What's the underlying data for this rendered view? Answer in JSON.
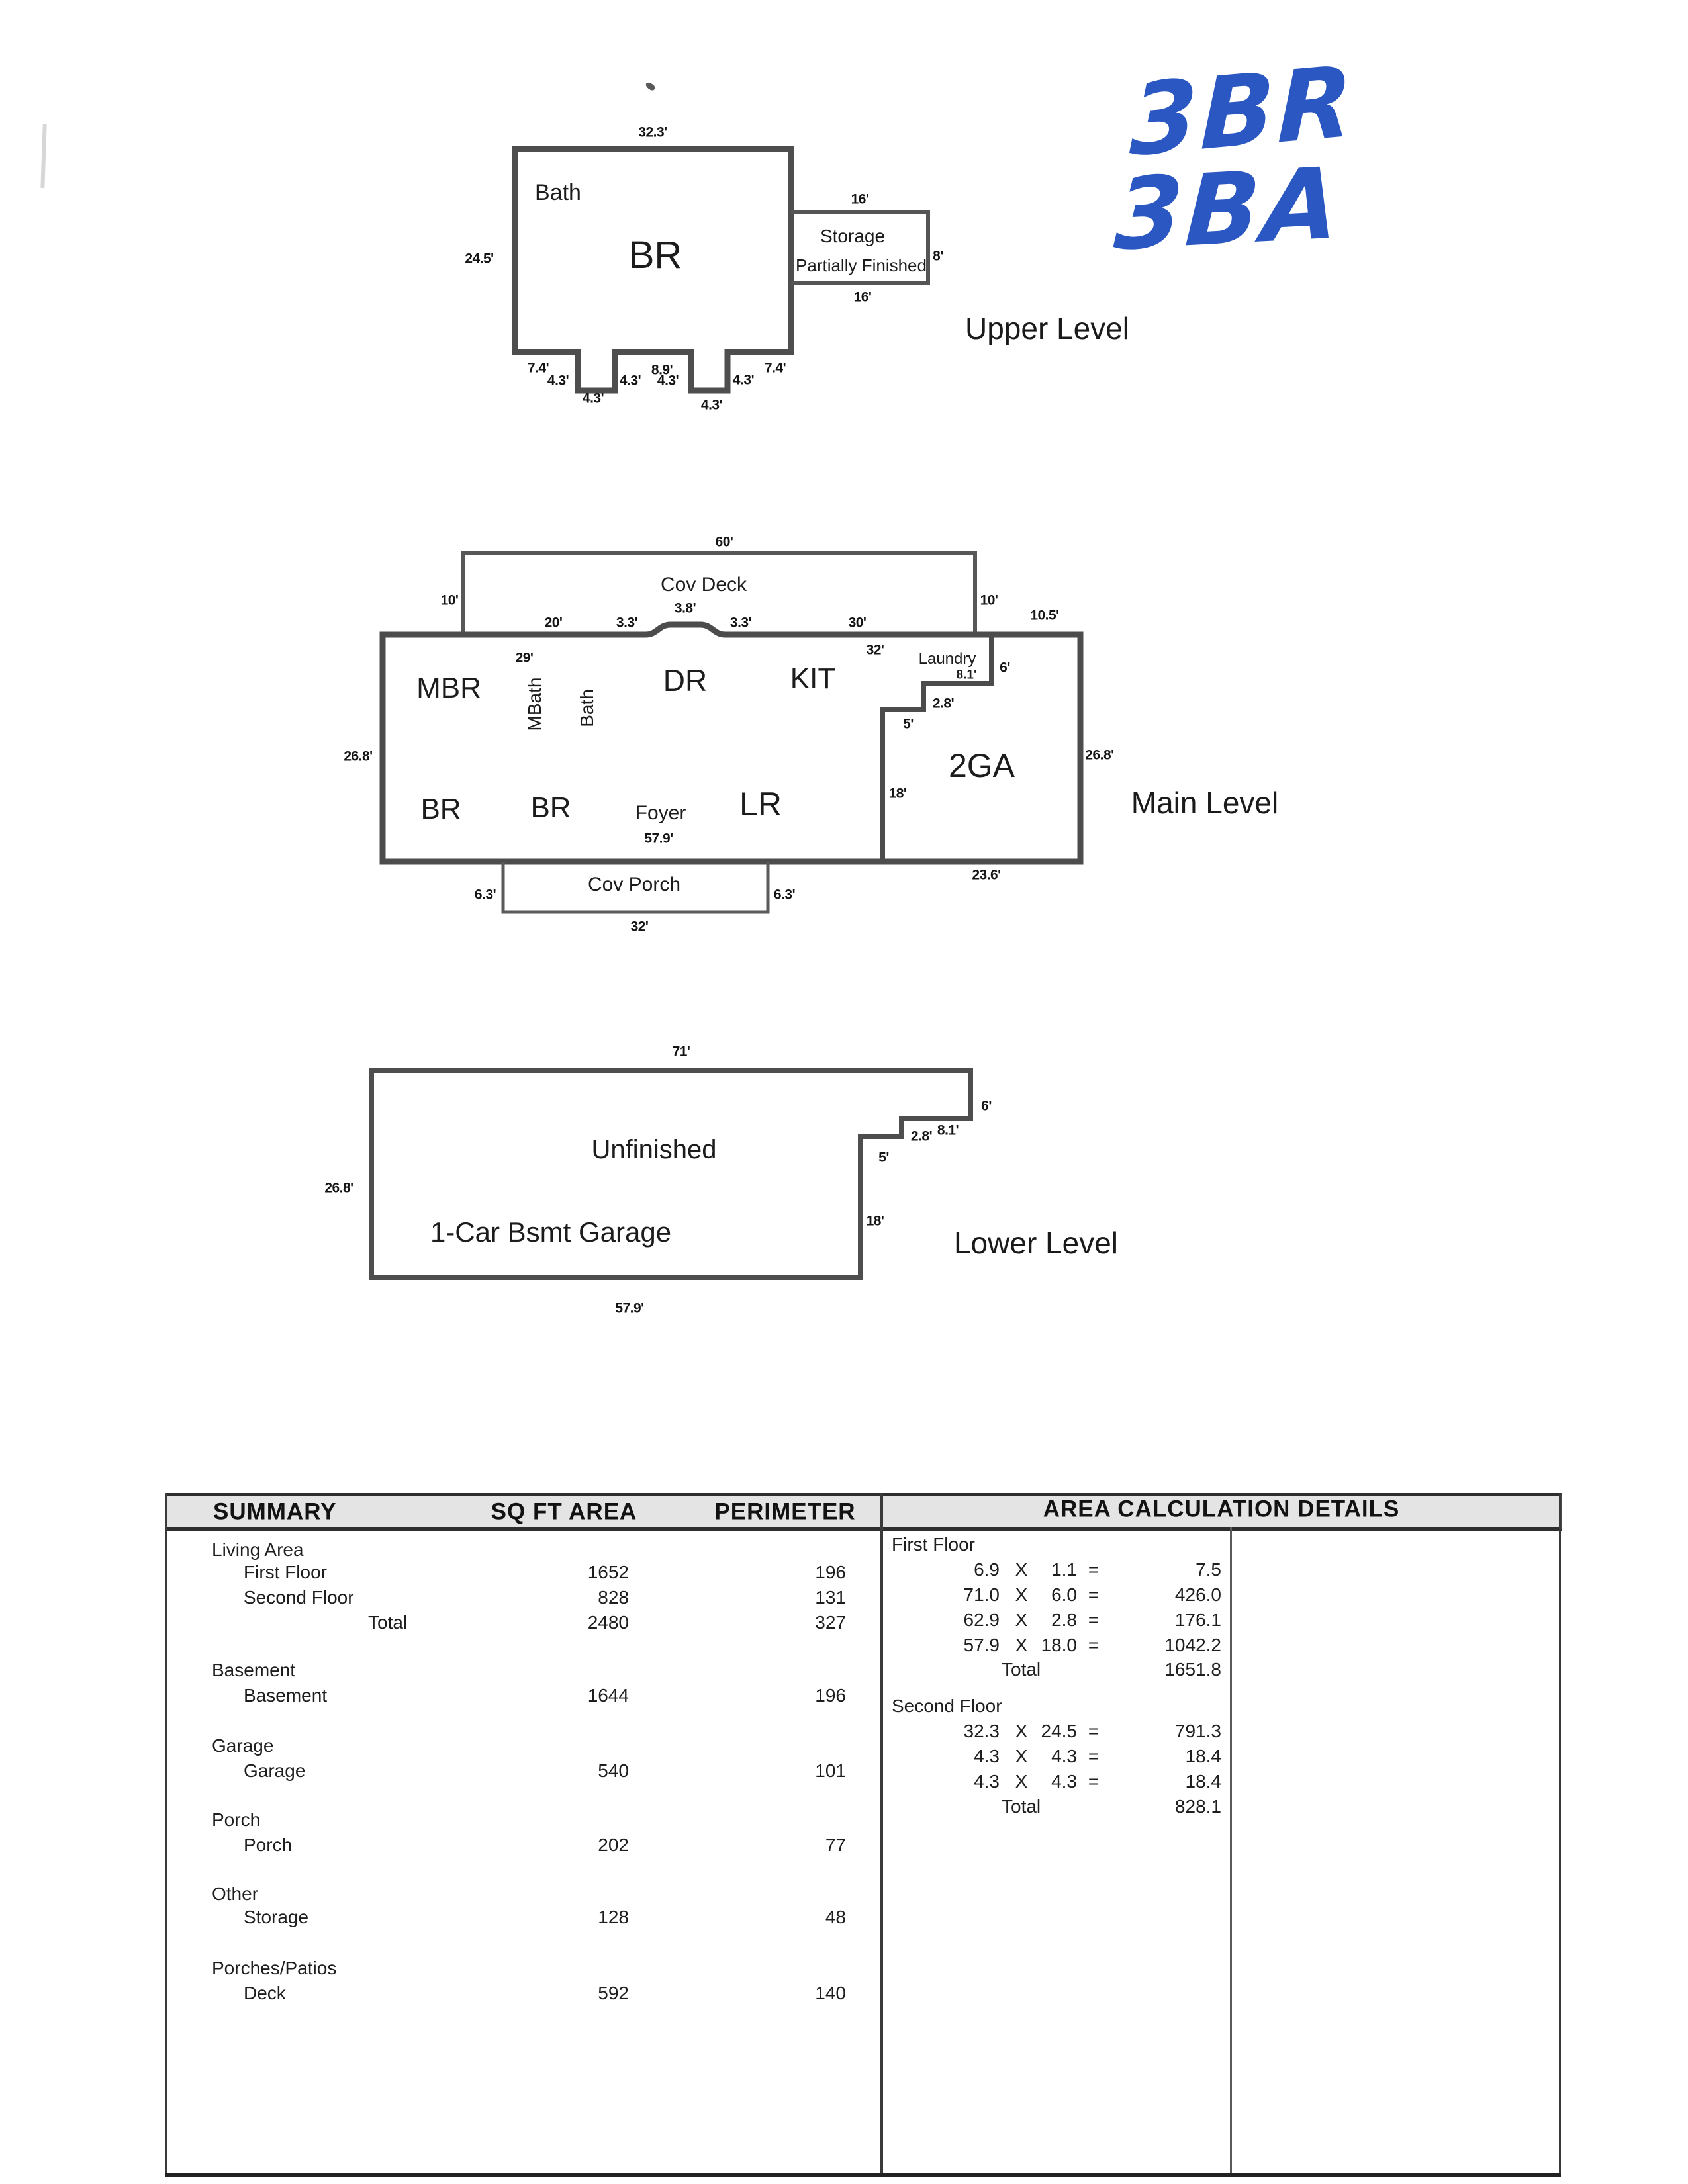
{
  "handwriting": {
    "line1": "3BR",
    "line2": "3BA",
    "ink": "#2b57c2"
  },
  "upper": {
    "title": "Upper Level",
    "rooms": {
      "bath": "Bath",
      "br": "BR",
      "storage": "Storage",
      "storage_note": "Partially Finished"
    },
    "dims": {
      "width": "32.3'",
      "height": "24.5'",
      "storage_top": "16'",
      "storage_right": "8'",
      "storage_bottom": "16'",
      "seg74": "7.4'",
      "seg89": "8.9'",
      "n43": "4.3'"
    }
  },
  "main": {
    "title": "Main Level",
    "rooms": {
      "deck": "Cov Deck",
      "mbr": "MBR",
      "mbath": "MBath",
      "bath": "Bath",
      "dr": "DR",
      "kit": "KIT",
      "laundry": "Laundry",
      "br": "BR",
      "foyer": "Foyer",
      "lr": "LR",
      "garage": "2GA",
      "porch": "Cov Porch"
    },
    "dims": {
      "deck_w": "60'",
      "deck_h": "10'",
      "garage_top": "10.5'",
      "seg20": "20'",
      "seg33": "3.3'",
      "seg38": "3.8'",
      "seg30": "30'",
      "int32": "32'",
      "int29": "29'",
      "height": "26.8'",
      "laund81": "8.1'",
      "laund6": "6'",
      "laund28": "2.8'",
      "laund5": "5'",
      "gar18": "18'",
      "gar_w": "23.6'",
      "bottom579": "57.9'",
      "porch63": "6.3'",
      "porch_w": "32'"
    }
  },
  "lower": {
    "title": "Lower Level",
    "rooms": {
      "unfinished": "Unfinished",
      "garage": "1-Car Bsmt Garage"
    },
    "dims": {
      "width": "71'",
      "height": "26.8'",
      "s6": "6'",
      "s28": "2.8'",
      "s81": "8.1'",
      "s5": "5'",
      "s18": "18'",
      "bottom": "57.9'"
    }
  },
  "table": {
    "headers": {
      "summary": "SUMMARY",
      "sqft": "SQ FT AREA",
      "perimeter": "PERIMETER",
      "details": "AREA CALCULATION DETAILS"
    },
    "groups": [
      {
        "name": "Living Area",
        "rows": [
          {
            "label": "First Floor",
            "sqft": "1652",
            "perimeter": "196"
          },
          {
            "label": "Second Floor",
            "sqft": "828",
            "perimeter": "131"
          }
        ],
        "total": {
          "label": "Total",
          "sqft": "2480",
          "perimeter": "327"
        }
      },
      {
        "name": "Basement",
        "rows": [
          {
            "label": "Basement",
            "sqft": "1644",
            "perimeter": "196"
          }
        ]
      },
      {
        "name": "Garage",
        "rows": [
          {
            "label": "Garage",
            "sqft": "540",
            "perimeter": "101"
          }
        ]
      },
      {
        "name": "Porch",
        "rows": [
          {
            "label": "Porch",
            "sqft": "202",
            "perimeter": "77"
          }
        ]
      },
      {
        "name": "Other",
        "rows": [
          {
            "label": "Storage",
            "sqft": "128",
            "perimeter": "48"
          }
        ]
      },
      {
        "name": "Porches/Patios",
        "rows": [
          {
            "label": "Deck",
            "sqft": "592",
            "perimeter": "140"
          }
        ]
      }
    ],
    "details": {
      "sections": [
        {
          "name": "First Floor",
          "rows": [
            {
              "a": "6.9",
              "op": "X",
              "b": "1.1",
              "eq": "=",
              "result": "7.5"
            },
            {
              "a": "71.0",
              "op": "X",
              "b": "6.0",
              "eq": "=",
              "result": "426.0"
            },
            {
              "a": "62.9",
              "op": "X",
              "b": "2.8",
              "eq": "=",
              "result": "176.1"
            },
            {
              "a": "57.9",
              "op": "X",
              "b": "18.0",
              "eq": "=",
              "result": "1042.2"
            }
          ],
          "total_label": "Total",
          "total": "1651.8"
        },
        {
          "name": "Second Floor",
          "rows": [
            {
              "a": "32.3",
              "op": "X",
              "b": "24.5",
              "eq": "=",
              "result": "791.3"
            },
            {
              "a": "4.3",
              "op": "X",
              "b": "4.3",
              "eq": "=",
              "result": "18.4"
            },
            {
              "a": "4.3",
              "op": "X",
              "b": "4.3",
              "eq": "=",
              "result": "18.4"
            }
          ],
          "total_label": "Total",
          "total": "828.1"
        }
      ]
    }
  }
}
